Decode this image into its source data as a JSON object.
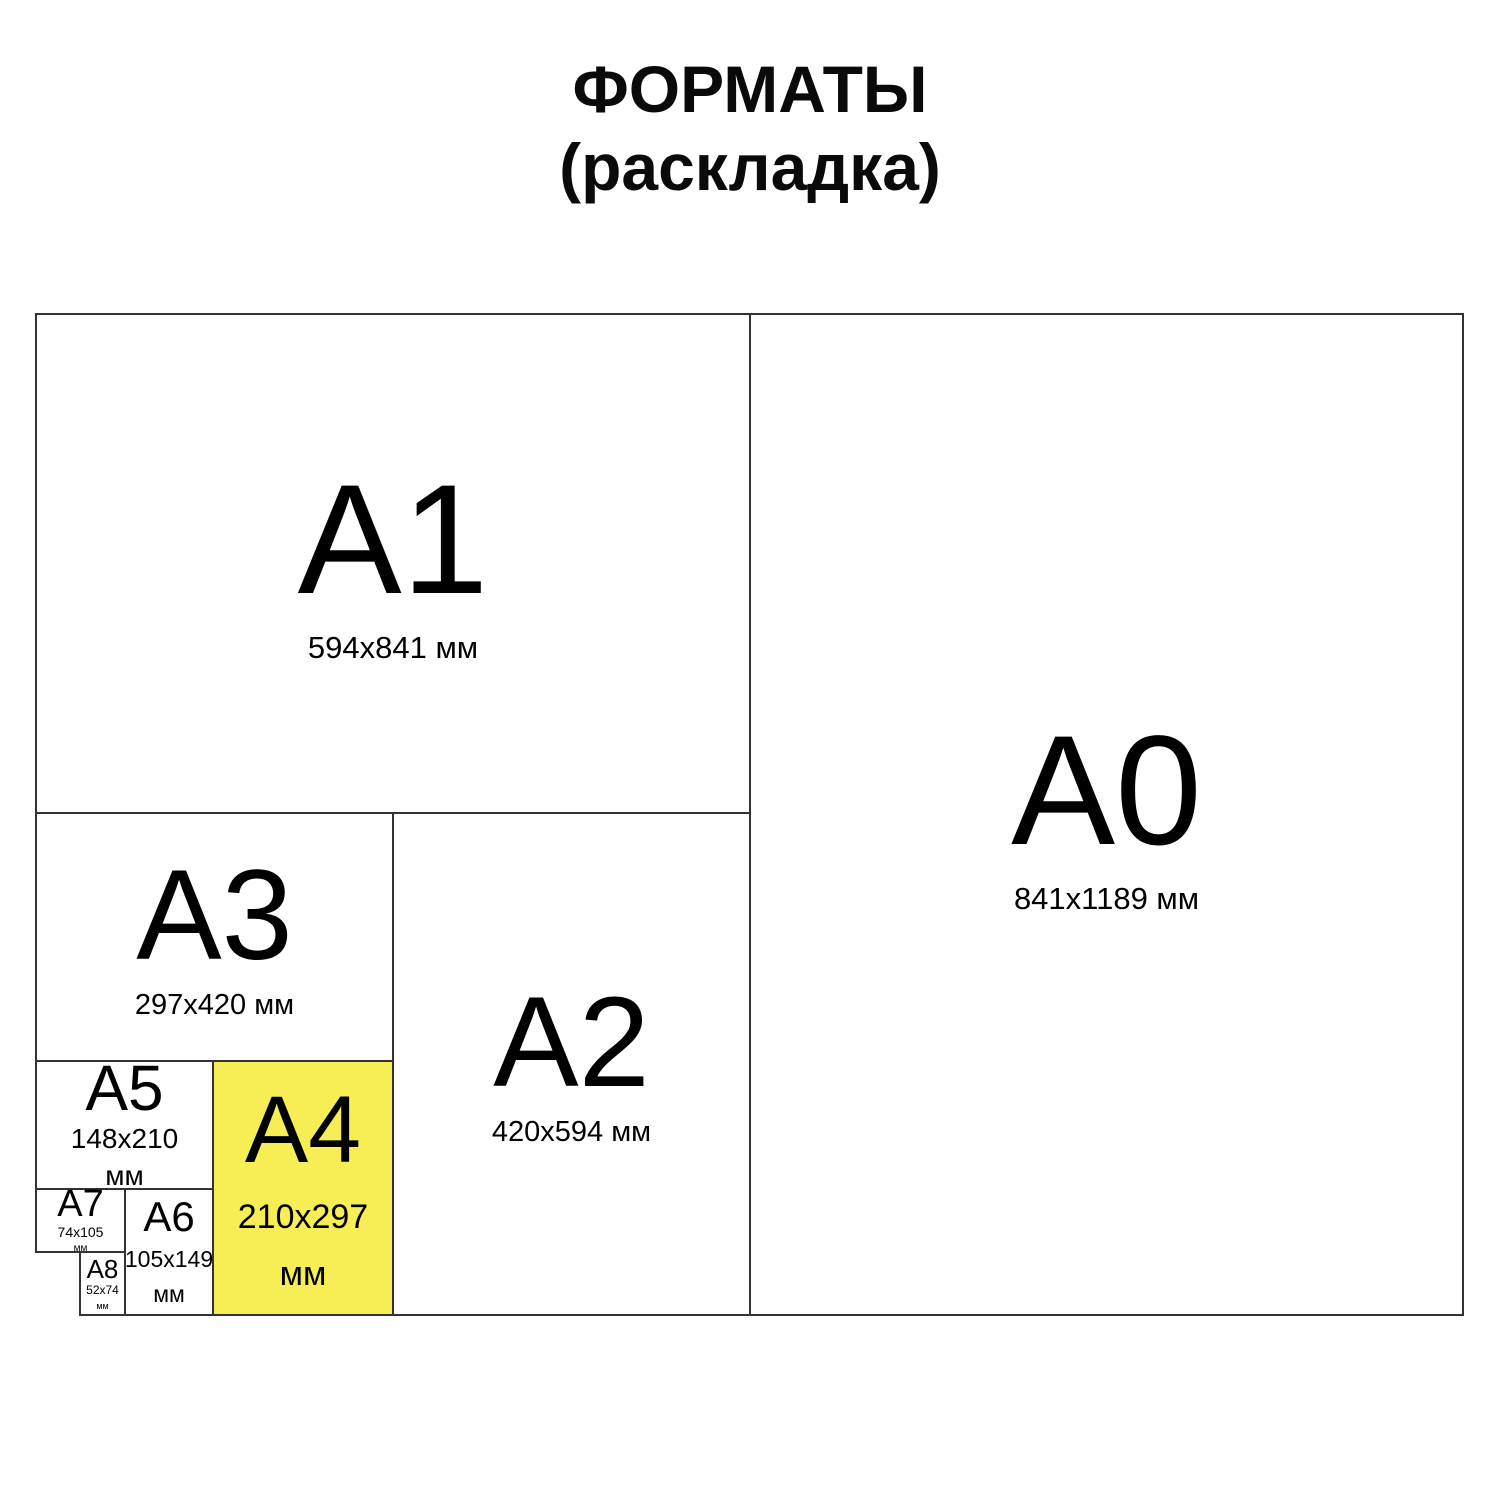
{
  "title": {
    "line1": "ФОРМАТЫ",
    "line2": "(раскладка)"
  },
  "colors": {
    "highlight": "#F7EE55",
    "line": "#333333",
    "text": "#000000",
    "background": "#FFFFFF"
  },
  "sheets": [
    {
      "name": "A0",
      "dims": [
        "841x1189 мм"
      ]
    },
    {
      "name": "A1",
      "dims": [
        "594x841 мм"
      ]
    },
    {
      "name": "A2",
      "dims": [
        "420x594 мм"
      ]
    },
    {
      "name": "A3",
      "dims": [
        "297x420 мм"
      ]
    },
    {
      "name": "A4",
      "dims": [
        "210x297",
        "мм"
      ],
      "highlighted": true
    },
    {
      "name": "A5",
      "dims": [
        "148x210",
        "мм"
      ]
    },
    {
      "name": "A6",
      "dims": [
        "105x149",
        "мм"
      ]
    },
    {
      "name": "A7",
      "dims": [
        "74x105",
        "мм"
      ]
    },
    {
      "name": "A8",
      "dims": [
        "52x74",
        "мм"
      ]
    }
  ]
}
